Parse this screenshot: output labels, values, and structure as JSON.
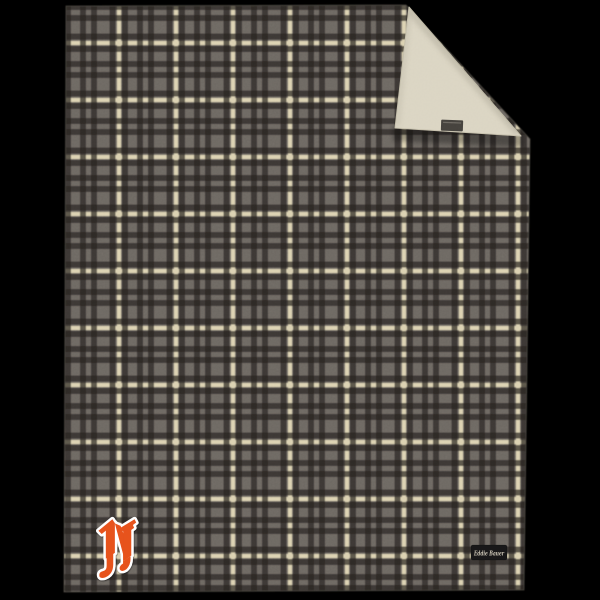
{
  "image": {
    "background_color": "#000000"
  },
  "blanket": {
    "plaid": {
      "base_color": "#6e6963",
      "dark_stripe_color": "#262320",
      "cream_stripe_color": "#dcd2b2"
    },
    "sherpa": {
      "color": "#dbd5c3"
    },
    "fold_tag": {
      "color": "#45423d",
      "stitch_color": "#8d887f"
    },
    "brand_label": {
      "text": "Eddie Bauer",
      "background_color": "#191819",
      "text_color": "#cfc8b8"
    },
    "monogram": {
      "letter": "N",
      "color": "#e7521b",
      "outline_color": "#ffffff"
    }
  }
}
